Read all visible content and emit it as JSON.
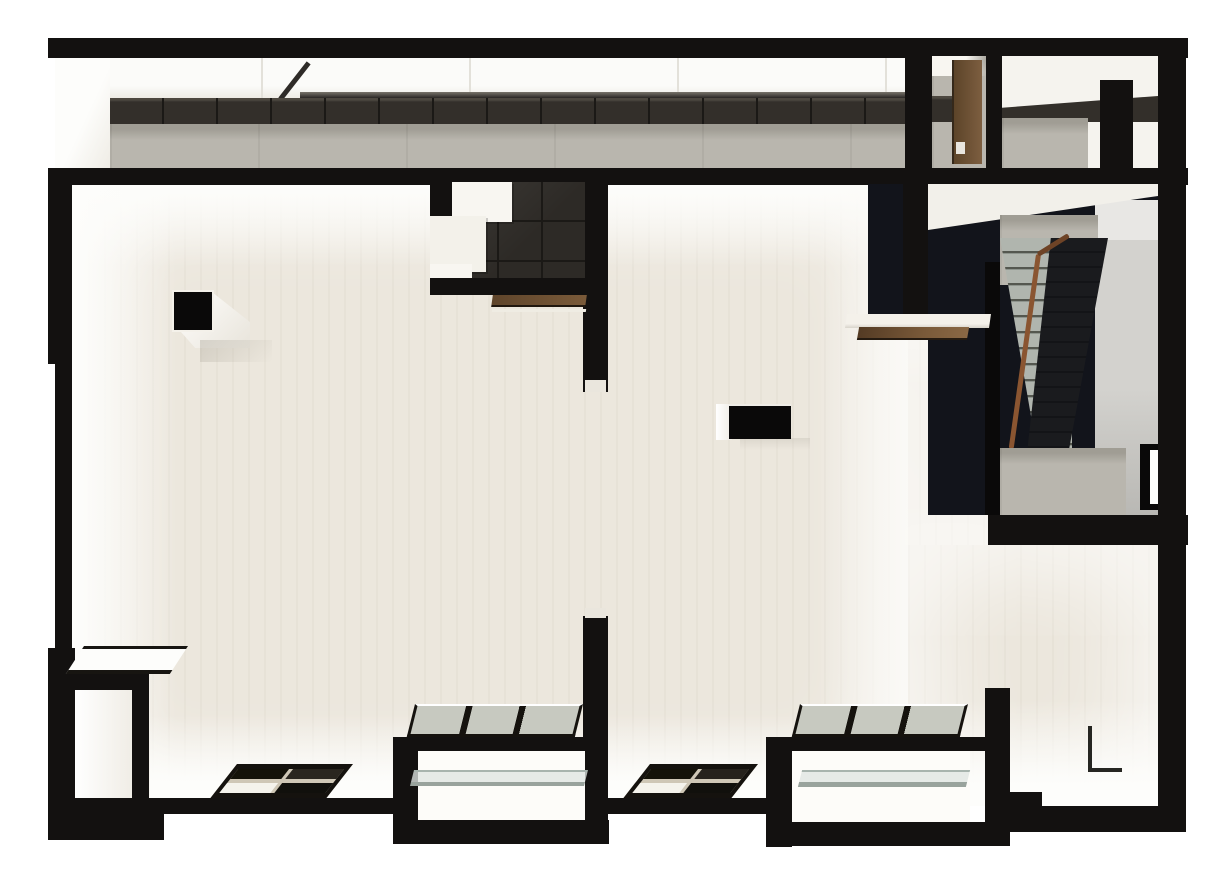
{
  "meta": {
    "type": "3d-architectural-floor-plan-render",
    "view": "top-down orthographic",
    "visible_text": "none",
    "description": "Monochrome top-down 3D render of an apartment floor: black walls, cream floors, skylit north gallery, dark tiled entry vestibules with wood doors, scissor stairwell, two south balconies with glass railings, window-seat alcove and two freestanding columns."
  },
  "regions": {
    "gallery": "north gallery corridor with linear skylight, dark tile wall and concrete walkway",
    "entry_rooms": "top-right entry vestibules with wood door and concrete floors",
    "stair_hall": "stairwell with opposing concrete and dark stair flights and wood handrail",
    "main_room": "open cream-floored living area",
    "vestibule": "dark tiled entry vestibule with three white steps and wood door",
    "balconies": "two recessed south balconies with three-pane glazing and glass guardrails",
    "alcove": "window-seat alcove with white framed bench table",
    "columns": "two freestanding black columns"
  },
  "elements": [
    {
      "name": "north-skylight-strip",
      "material": "skylight"
    },
    {
      "name": "dark-tile-wall-strip",
      "material": "tile"
    },
    {
      "name": "concrete-walkway",
      "material": "concrete"
    },
    {
      "name": "entry-door-wood",
      "material": "wood"
    },
    {
      "name": "stair-flight-concrete",
      "material": "stair"
    },
    {
      "name": "stair-flight-dark",
      "material": "stair_dark"
    },
    {
      "name": "stair-handrail",
      "material": "rail"
    },
    {
      "name": "stair-window-slot",
      "material": "face"
    },
    {
      "name": "vestibule-floor-tiles",
      "material": "tile"
    },
    {
      "name": "vestibule-steps",
      "material": "face"
    },
    {
      "name": "vestibule-door-wood",
      "material": "wood"
    },
    {
      "name": "column-square",
      "material": "wall_deep"
    },
    {
      "name": "column-rect",
      "material": "wall_deep"
    },
    {
      "name": "window-grid-left",
      "material": "winframe"
    },
    {
      "name": "window-grid-mid",
      "material": "winframe"
    },
    {
      "name": "balcony-glazing-3pane",
      "material": "pane"
    },
    {
      "name": "balcony-glass-guardrail",
      "material": "glass"
    },
    {
      "name": "alcove-bench-table",
      "material": "face"
    }
  ],
  "palette": {
    "bg": "#ffffff",
    "wall": "#131110",
    "wall_deep": "#0a0909",
    "floor": "#ece7dd",
    "floor_bright": "#f8f6f1",
    "face": "#fdfdfb",
    "face_shade": "#efece5",
    "concrete": "#b9b6ae",
    "concrete_edge": "#a09d94",
    "tile": "#332f2a",
    "tile_seam": "#1b1916",
    "tile_hi": "#4d4840",
    "skylight": "#fbfbf9",
    "skylight_seam": "#e3e1da",
    "wood": "#6e5135",
    "wood_light": "#85613e",
    "rail": "#8a5531",
    "rail_dark": "#6e4326",
    "glass": "#dfe5e2",
    "glass_edge": "#a8b4ae",
    "glass_edge2": "#99a39d",
    "stair": "#b0b5ae",
    "stair_riser": "#54574f",
    "stair_dark": "#131417",
    "void": "#12141b",
    "graywall": "#d3d2ce",
    "pane": "#c7c9c0",
    "mullion": "#cfc7b6",
    "winframe": "#15120e",
    "cap": "#eae6dd"
  }
}
